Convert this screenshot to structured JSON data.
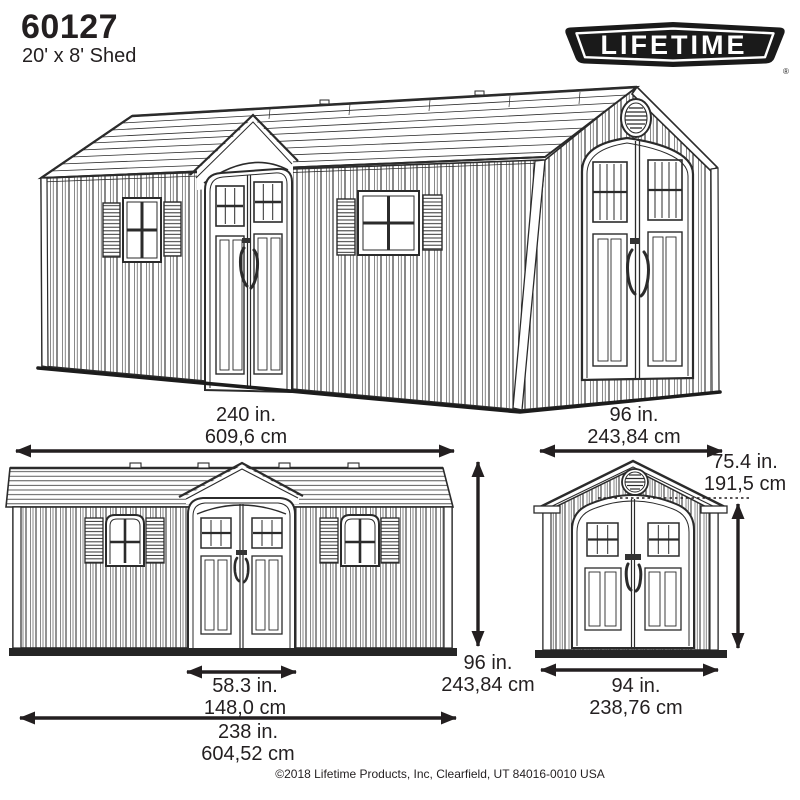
{
  "header": {
    "model": "60127",
    "subtitle": "20' x 8' Shed"
  },
  "logo": {
    "brand": "LIFETIME",
    "registered_mark": "®"
  },
  "dimensions": {
    "front_width": {
      "inches": "240 in.",
      "cm": "609,6 cm"
    },
    "end_width": {
      "inches": "96 in.",
      "cm": "243,84 cm"
    },
    "peak_height": {
      "inches": "96 in.",
      "cm": "243,84 cm"
    },
    "door_opening_width": {
      "inches": "58.3 in.",
      "cm": "148,0 cm"
    },
    "front_base_width": {
      "inches": "238 in.",
      "cm": "604,52 cm"
    },
    "eave_height": {
      "inches": "75.4 in.",
      "cm": "191,5 cm"
    },
    "end_base_width": {
      "inches": "94 in.",
      "cm": "238,76 cm"
    }
  },
  "footer": {
    "copyright": "©2018 Lifetime Products, Inc, Clearfield, UT 84016-0010 USA"
  },
  "colors": {
    "ink": "#231f20",
    "line_art": "#2b2b2b",
    "logo_background": "#1a1a1a",
    "paper": "#ffffff"
  }
}
